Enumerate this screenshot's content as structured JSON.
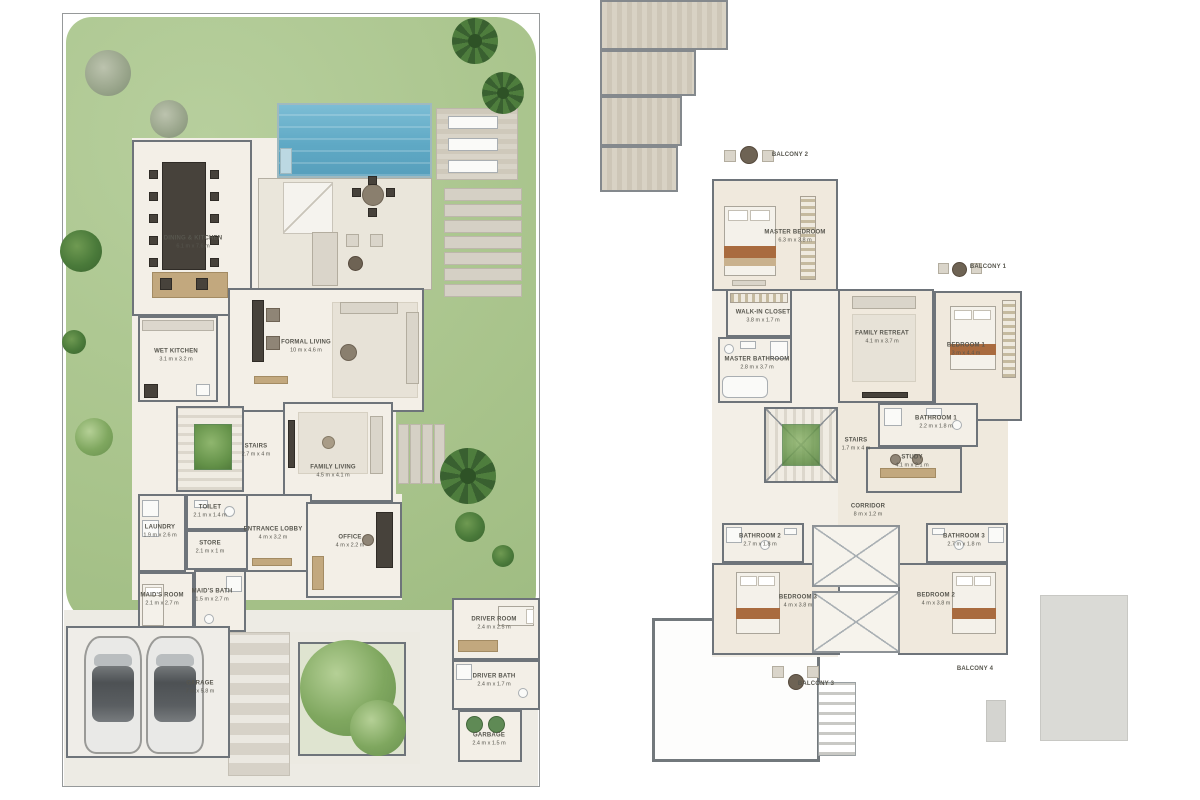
{
  "document_type": "villa floor plans",
  "colors": {
    "garden_green": "#a9c48c",
    "pool_blue": "#64aac6",
    "wall_grey": "#6e747a",
    "floor_cream": "#f3efe7",
    "wood_tan": "#c2a87e",
    "accent_rust": "#a96b3f"
  },
  "ground_floor": {
    "name": "Ground Floor Plan",
    "garage_cars": 2,
    "rooms": [
      {
        "label": "DINING & KITCHEN",
        "dims": "6.1 m x 7.6 m"
      },
      {
        "label": "WET KITCHEN",
        "dims": "3.1 m x 3.2 m"
      },
      {
        "label": "FORMAL LIVING",
        "dims": "10 m x 4.6 m"
      },
      {
        "label": "STAIRS",
        "dims": "2.7 m x 4 m"
      },
      {
        "label": "FAMILY LIVING",
        "dims": "4.5 m x 4.1 m"
      },
      {
        "label": "TOILET",
        "dims": "2.1 m x 1.4 m"
      },
      {
        "label": "LAUNDRY",
        "dims": "1.9 m x 2.6 m"
      },
      {
        "label": "STORE",
        "dims": "2.1 m x 1 m"
      },
      {
        "label": "MAID'S BATH",
        "dims": "1.5 m x 2.7 m"
      },
      {
        "label": "MAID'S ROOM",
        "dims": "2.1 m x 2.7 m"
      },
      {
        "label": "ENTRANCE LOBBY",
        "dims": "4 m x 3.2 m"
      },
      {
        "label": "OFFICE",
        "dims": "4 m x 2.2 m"
      },
      {
        "label": "GARAGE",
        "dims": "7 m x 5.8 m"
      },
      {
        "label": "DRIVER ROOM",
        "dims": "2.4 m x 2.5 m"
      },
      {
        "label": "DRIVER BATH",
        "dims": "2.4 m x 1.7 m"
      },
      {
        "label": "GARBAGE",
        "dims": "2.4 m x 1.5 m"
      }
    ]
  },
  "first_floor": {
    "name": "First Floor Plan",
    "rooms": [
      {
        "label": "BALCONY 2",
        "dims": ""
      },
      {
        "label": "MASTER BEDROOM",
        "dims": "6.3 m x 3.8 m"
      },
      {
        "label": "WALK-IN CLOSET",
        "dims": "3.8 m x 1.7 m"
      },
      {
        "label": "MASTER BATHROOM",
        "dims": "2.8 m x 3.7 m"
      },
      {
        "label": "FAMILY RETREAT",
        "dims": "4.1 m x 3.7 m"
      },
      {
        "label": "BEDROOM 1",
        "dims": "3 m x 4.4 m"
      },
      {
        "label": "BALCONY 1",
        "dims": ""
      },
      {
        "label": "BATHROOM 1",
        "dims": "2.2 m x 1.8 m"
      },
      {
        "label": "STAIRS",
        "dims": "1.7 m x 4 m"
      },
      {
        "label": "STUDY",
        "dims": "4.1 m x 2.1 m"
      },
      {
        "label": "CORRIDOR",
        "dims": "8 m x 1.2 m"
      },
      {
        "label": "BATHROOM 2",
        "dims": "2.7 m x 1.8 m"
      },
      {
        "label": "BATHROOM 3",
        "dims": "2.7 m x 1.8 m"
      },
      {
        "label": "BEDROOM 3",
        "dims": "4 m x 3.8 m"
      },
      {
        "label": "BEDROOM 2",
        "dims": "4 m x 3.8 m"
      },
      {
        "label": "BALCONY 3",
        "dims": ""
      },
      {
        "label": "BALCONY 4",
        "dims": ""
      }
    ]
  }
}
